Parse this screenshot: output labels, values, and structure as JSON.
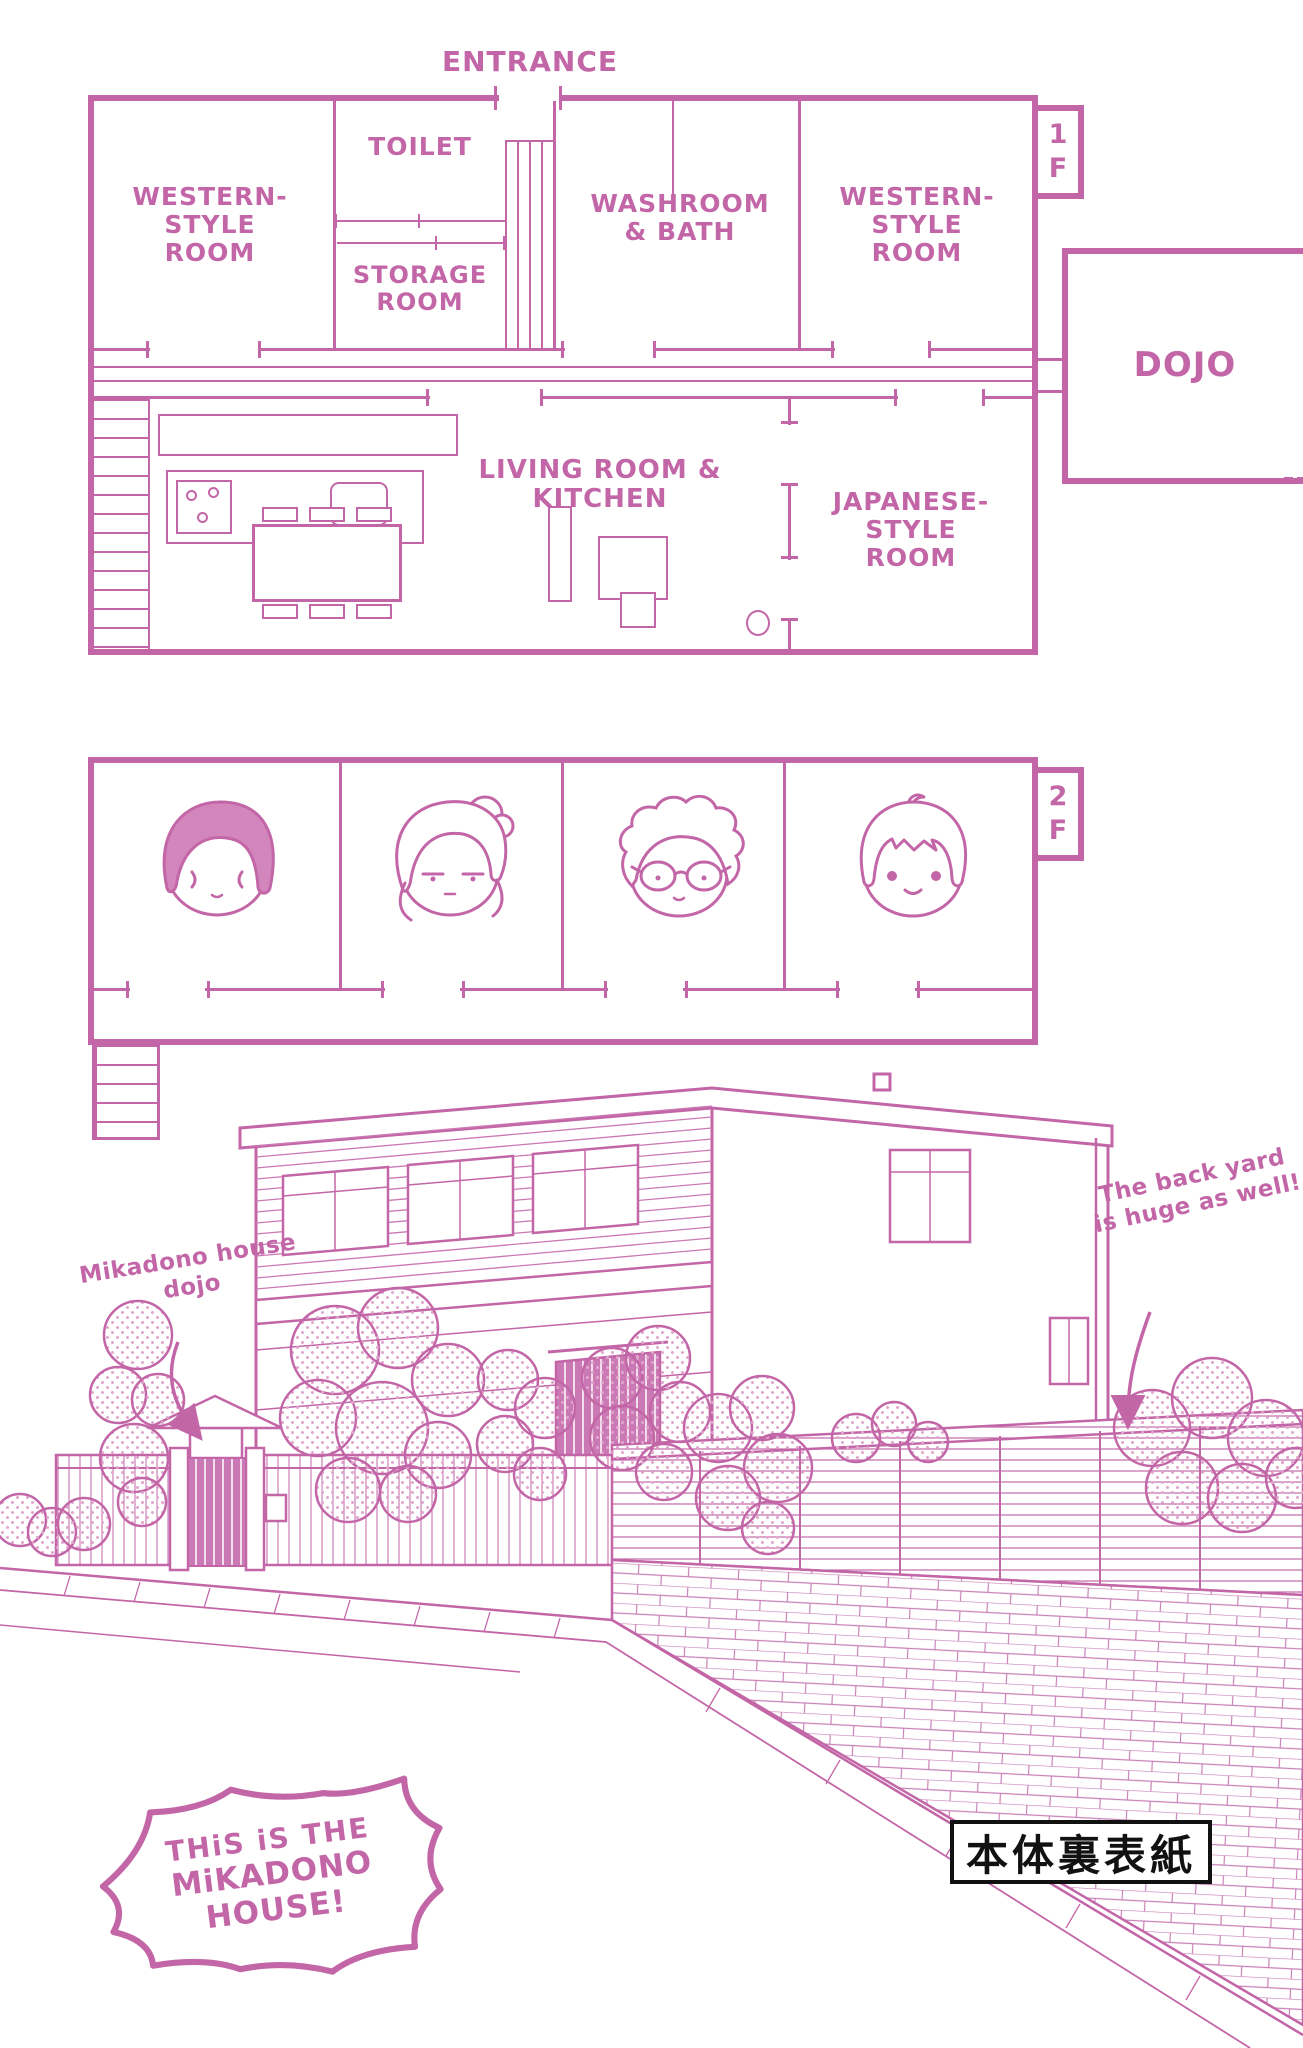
{
  "colors": {
    "ink": "#c366a7",
    "fill_pink": "#d286bc",
    "halftone": "#e0a6cc",
    "black": "#111111"
  },
  "floor1": {
    "badge": "1\nF",
    "entrance": "ENTRANCE",
    "rooms": {
      "western_left": "WESTERN-\nSTYLE\nROOM",
      "toilet": "TOILET",
      "storage": "STORAGE\nROOM",
      "washroom": "WASHROOM\n& BATH",
      "western_right": "WESTERN-\nSTYLE\nROOM",
      "living": "LIVING ROOM & KITCHEN",
      "japanese": "JAPANESE-\nSTYLE\nROOM",
      "dojo": "DOJO"
    }
  },
  "floor2": {
    "badge": "2\nF",
    "residents": [
      {
        "icon": "dark-bob-hair-resident-face-icon"
      },
      {
        "icon": "blonde-bun-hair-resident-face-icon"
      },
      {
        "icon": "messy-hair-glasses-resident-face-icon"
      },
      {
        "icon": "short-hair-boy-resident-face-icon"
      }
    ]
  },
  "illustration": {
    "dojo_note": "Mikadono house\ndojo",
    "backyard_note": "The back yard\nis huge as well!"
  },
  "footer": {
    "bubble_line1": "THiS iS THE",
    "bubble_line2": "MiKADONO HOUSE!",
    "back_cover_label": "本体裏表紙"
  }
}
